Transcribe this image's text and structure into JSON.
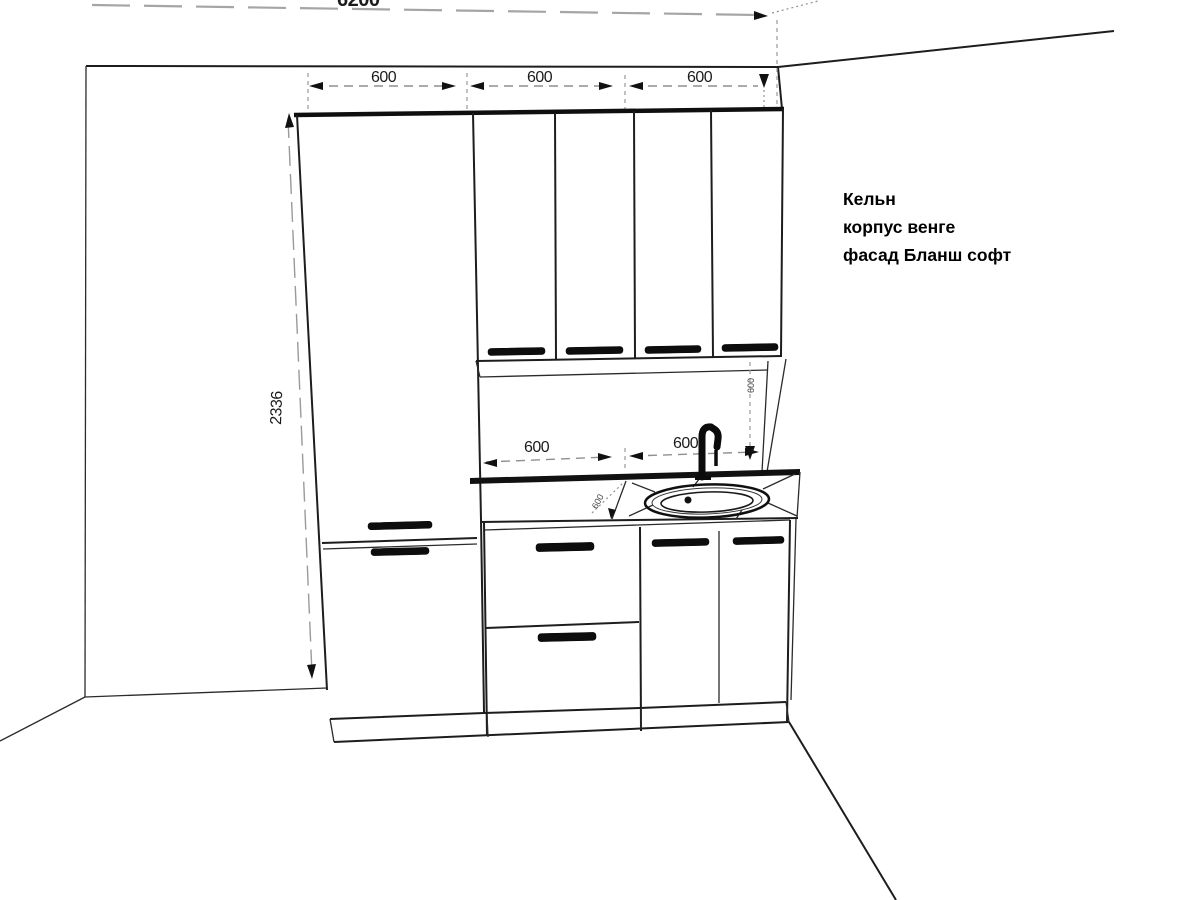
{
  "annotation": {
    "line1": "Кельн",
    "line2": "корпус венге",
    "line3": "фасад Бланш софт"
  },
  "dimensions": {
    "overall_top": "6200",
    "upper_600s": [
      "600",
      "600",
      "600"
    ],
    "cabinet_height": "2336",
    "counter_600s": [
      "600",
      "600"
    ],
    "counter_depth": "600",
    "splash_height": "600"
  },
  "colors": {
    "line": "#1d1d1d",
    "dimension": "#8f8f8f",
    "text": "#000000",
    "background": "#ffffff"
  }
}
